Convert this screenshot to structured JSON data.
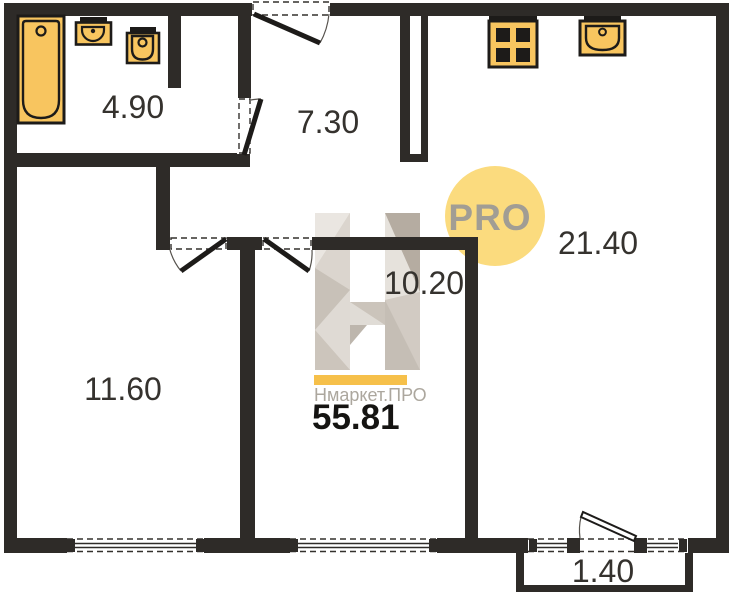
{
  "watermark": {
    "brand": "Нмаркет.ПРО",
    "badge": "PRO",
    "logo_letter": "H",
    "total_area": "55.81"
  },
  "rooms": [
    {
      "id": "bathroom",
      "area": "4.90"
    },
    {
      "id": "hallway",
      "area": "7.30"
    },
    {
      "id": "kitchen-living",
      "area": "21.40"
    },
    {
      "id": "room-a",
      "area": "10.20"
    },
    {
      "id": "room-b",
      "area": "11.60"
    },
    {
      "id": "balcony",
      "area": "1.40"
    }
  ],
  "colors": {
    "wall": "#2e2b28",
    "fixture_fill": "#f8c55f",
    "fixture_stroke": "#1d1b19",
    "badge_bg": "#fbdb7e",
    "badge_text": "#a19d94",
    "accent_bar": "#f6c04a",
    "brand_text": "#aca79e",
    "label_text": "#35322e",
    "logo_gray": "#d6d0c8"
  }
}
